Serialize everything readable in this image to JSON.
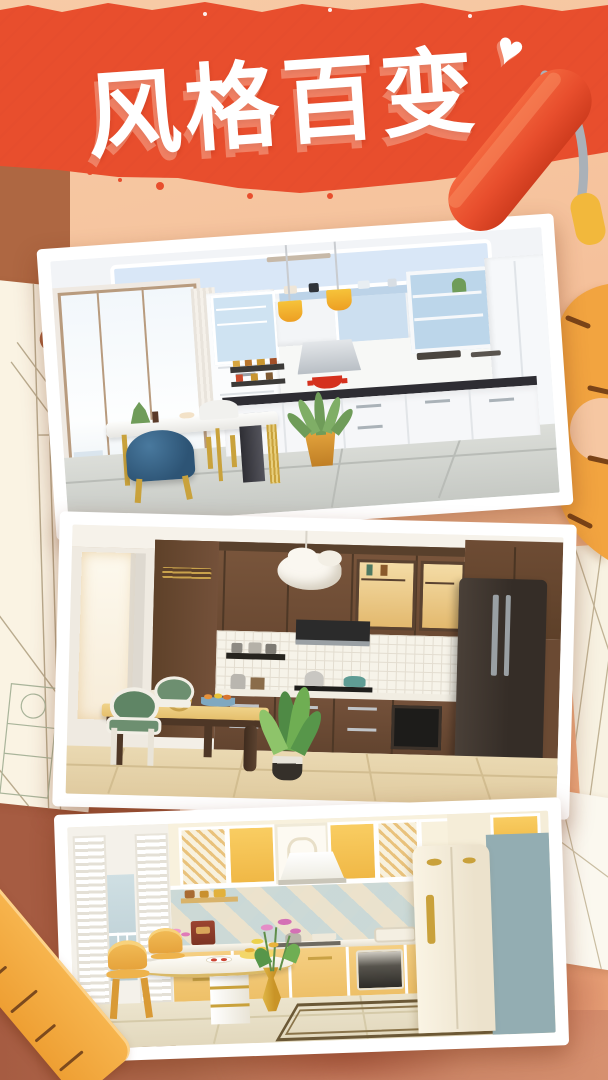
{
  "banner": {
    "title": "风格百变",
    "heart_icon": "heart-icon",
    "background_color": "#e84e2d",
    "title_color": "#ffffff"
  },
  "photos": [
    {
      "name": "modern-white-kitchen",
      "description": "Bright white modern kitchen: blue glass upper cabinets, yellow pendant lamps, black countertop with red pot, marble dining table with gold legs, blue velvet chair, agave plant in orange pot, large window wall"
    },
    {
      "name": "classic-walnut-kitchen",
      "description": "Classic dark walnut kitchen: white tile backsplash, lit glass cabinets, black range hood, dark fridge, yellow-top dining table with green oval-back chairs, white cloud pendant, light oak floor, leafy plant"
    },
    {
      "name": "retro-yellow-kitchen",
      "description": "Retro pastel yellow kitchen: diamond tile backsplash, white range hood, cream retro fridge with gold handles, blue side panel, white pedestal dining table with gold trim, gold chairs, golden vase with pink flowers, tiled floor with greek-key border"
    }
  ],
  "decorations": {
    "paint_roller": "paint-roller-icon",
    "protractor": "protractor-icon",
    "ruler": "ruler-icon",
    "sketch_paper": "blueprint-sketch-paper",
    "colors": {
      "banner_red": "#e84e2d",
      "background_peach": "#f5c09a",
      "terracotta": "#a65c42",
      "tool_orange": "#f2a440",
      "paper_cream": "#faf3e3"
    }
  }
}
